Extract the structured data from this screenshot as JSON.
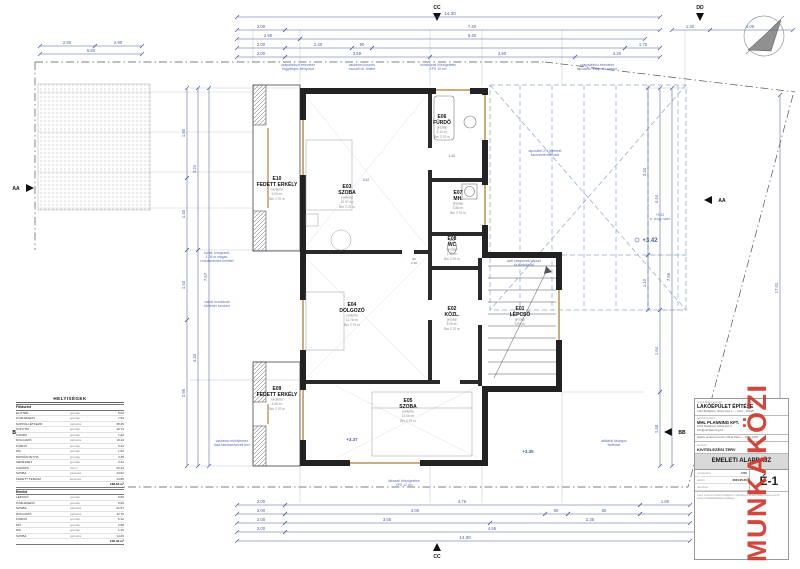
{
  "stamp": "MUNKAKÖZI",
  "colors": {
    "dim": "#4a5f9e",
    "note": "#5b6fb5",
    "roof": "#8ca6cf",
    "wall": "#222222",
    "tan": "#c8a06a",
    "red": "#d0382c"
  },
  "table": {
    "title": "HELYISÉGEK",
    "rows": [
      {
        "cls": "trow head",
        "name": "Földszint",
        "fin": "",
        "area": ""
      },
      {
        "cls": "trow",
        "name": "ELŐTÉR",
        "fin": "greslap",
        "area": "5.62"
      },
      {
        "cls": "trow",
        "name": "KÖZLEKEDŐ",
        "fin": "greslap",
        "area": "7.54"
      },
      {
        "cls": "trow",
        "name": "NAPPALI-ÉTKEZŐ",
        "fin": "parketta",
        "area": "38.45"
      },
      {
        "cls": "trow",
        "name": "KONYHA",
        "fin": "greslap",
        "area": "15.72"
      },
      {
        "cls": "trow",
        "name": "KAMRA",
        "fin": "greslap",
        "area": "1.92"
      },
      {
        "cls": "trow",
        "name": "DOLGOZÓ",
        "fin": "parketta",
        "area": "10.14"
      },
      {
        "cls": "trow",
        "name": "FÜRDŐ",
        "fin": "greslap",
        "area": "5.24"
      },
      {
        "cls": "trow",
        "name": "WC",
        "fin": "greslap",
        "area": "1.52"
      },
      {
        "cls": "trow",
        "name": "MOSÓKONYHA",
        "fin": "greslap",
        "area": "4.35"
      },
      {
        "cls": "trow",
        "name": "GÉPÉSZET",
        "fin": "greslap",
        "area": "3.41"
      },
      {
        "cls": "trow",
        "name": "GARÁZS",
        "fin": "beton",
        "area": "20.44"
      },
      {
        "cls": "trow",
        "name": "SZOBA",
        "fin": "parketta",
        "area": "13.62"
      },
      {
        "cls": "trow",
        "name": "FEDETT TERASZ",
        "fin": "kerámia",
        "area": "14.85"
      },
      {
        "cls": "trow sum",
        "name": "",
        "fin": "",
        "area": "188.62 m²"
      },
      {
        "cls": "trow head",
        "name": "Emelet",
        "fin": "",
        "area": ""
      },
      {
        "cls": "trow",
        "name": "LÉPCSŐ",
        "fin": "greslap",
        "area": "6.80"
      },
      {
        "cls": "trow",
        "name": "KÖZLEKEDŐ",
        "fin": "greslap",
        "area": "5.06"
      },
      {
        "cls": "trow",
        "name": "SZOBA",
        "fin": "parketta",
        "area": "21.97"
      },
      {
        "cls": "trow",
        "name": "DOLGOZÓ",
        "fin": "parketta",
        "area": "12.76"
      },
      {
        "cls": "trow",
        "name": "FÜRDŐ",
        "fin": "greslap",
        "area": "6.12"
      },
      {
        "cls": "trow",
        "name": "MH.",
        "fin": "greslap",
        "area": "2.88"
      },
      {
        "cls": "trow",
        "name": "WC",
        "fin": "greslap",
        "area": "1.15"
      },
      {
        "cls": "trow",
        "name": "SZOBA",
        "fin": "parketta",
        "area": "14.06"
      },
      {
        "cls": "trow sum",
        "name": "",
        "fin": "",
        "area": "106.40 m²"
      }
    ]
  },
  "titleblock": {
    "client_label": "megrendelő / építtető",
    "project": "LAKÓÉPÜLET ÉPÍTÉSE",
    "project_addr": "1112 Budapest, Minta utca 1. — Hrsz.: 1234/5",
    "designer_label": "generál tervező",
    "firm": "MHL PLANNING KFT.",
    "firm_addr1": "1023 Budapest, Minta köz 2.",
    "firm_addr2": "info@mhlplanning.hu",
    "resp": "felelős építész tervező: Minta Péter — É 01-2345",
    "phase_label": "tervfázis",
    "phase": "KIVITELEZÉSI TERV",
    "title": "EMELETI ALAPRAJZ",
    "scale_label": "méretarány",
    "scale": "1:50",
    "date_label": "dátum",
    "date": "2021.05.25",
    "sheet_label": "rajzszám",
    "sheet": "É-1",
    "note": "A terv a tervező szellemi tulajdona, másolása és felhasználása csak a tervező írásos hozzájárulásával lehetséges."
  },
  "drawing": {
    "dim_lines": [
      [
        237,
        17,
        660,
        17
      ],
      [
        237,
        30,
        285,
        30
      ],
      [
        285,
        30,
        660,
        30
      ],
      [
        237,
        39,
        300,
        39
      ],
      [
        300,
        39,
        645,
        39
      ],
      [
        237,
        48,
        285,
        48
      ],
      [
        285,
        48,
        352,
        48
      ],
      [
        352,
        48,
        372,
        48
      ],
      [
        372,
        48,
        625,
        48
      ],
      [
        625,
        48,
        660,
        48
      ],
      [
        237,
        57,
        285,
        57
      ],
      [
        285,
        57,
        430,
        57
      ],
      [
        430,
        57,
        575,
        57
      ],
      [
        575,
        57,
        660,
        57
      ],
      [
        40,
        46,
        95,
        46
      ],
      [
        95,
        46,
        142,
        46
      ],
      [
        40,
        54,
        142,
        54
      ],
      [
        672,
        30,
        710,
        30
      ],
      [
        710,
        30,
        793,
        30
      ],
      [
        237,
        505,
        285,
        505
      ],
      [
        285,
        505,
        640,
        505
      ],
      [
        640,
        505,
        690,
        505
      ],
      [
        237,
        514,
        285,
        514
      ],
      [
        285,
        514,
        545,
        514
      ],
      [
        545,
        514,
        568,
        514
      ],
      [
        568,
        514,
        640,
        514
      ],
      [
        640,
        514,
        690,
        514
      ],
      [
        237,
        523,
        285,
        523
      ],
      [
        285,
        523,
        490,
        523
      ],
      [
        490,
        523,
        690,
        523
      ],
      [
        237,
        532,
        285,
        532
      ],
      [
        285,
        532,
        700,
        532
      ],
      [
        237,
        541,
        690,
        541
      ],
      [
        187,
        88,
        187,
        178
      ],
      [
        187,
        178,
        187,
        250
      ],
      [
        187,
        250,
        187,
        320
      ],
      [
        187,
        320,
        187,
        466
      ],
      [
        198,
        88,
        198,
        250
      ],
      [
        198,
        250,
        198,
        466
      ],
      [
        209,
        88,
        209,
        466
      ],
      [
        648,
        88,
        648,
        255
      ],
      [
        648,
        255,
        648,
        310
      ],
      [
        660,
        88,
        660,
        310
      ],
      [
        660,
        310,
        660,
        392
      ],
      [
        660,
        392,
        660,
        466
      ],
      [
        672,
        88,
        672,
        466
      ],
      [
        780,
        95,
        780,
        480
      ]
    ],
    "texts": [
      {
        "x": 450,
        "y": 15,
        "t": "14.30",
        "s": 4.6
      },
      {
        "x": 261,
        "y": 28,
        "t": "2.00"
      },
      {
        "x": 472,
        "y": 28,
        "t": "7.40"
      },
      {
        "x": 268,
        "y": 37,
        "t": "2.90"
      },
      {
        "x": 472,
        "y": 37,
        "t": "6.40"
      },
      {
        "x": 261,
        "y": 46,
        "t": "2.00"
      },
      {
        "x": 318,
        "y": 46,
        "t": "2.40"
      },
      {
        "x": 362,
        "y": 46,
        "t": "90"
      },
      {
        "x": 643,
        "y": 46,
        "t": "1.75"
      },
      {
        "x": 261,
        "y": 55,
        "t": "2.00"
      },
      {
        "x": 357,
        "y": 55,
        "t": "3.59"
      },
      {
        "x": 502,
        "y": 55,
        "t": "2.90"
      },
      {
        "x": 617,
        "y": 55,
        "t": "4.20"
      },
      {
        "x": 67,
        "y": 44,
        "t": "2.93"
      },
      {
        "x": 118,
        "y": 44,
        "t": "2.90"
      },
      {
        "x": 91,
        "y": 52,
        "t": "5.83"
      },
      {
        "x": 690,
        "y": 28,
        "t": "1.30"
      },
      {
        "x": 750,
        "y": 28,
        "t": "4.05"
      },
      {
        "x": 261,
        "y": 503,
        "t": "2.00"
      },
      {
        "x": 462,
        "y": 503,
        "t": "4.75"
      },
      {
        "x": 665,
        "y": 503,
        "t": "1.80"
      },
      {
        "x": 261,
        "y": 512,
        "t": "2.00"
      },
      {
        "x": 415,
        "y": 512,
        "t": "4.00"
      },
      {
        "x": 556,
        "y": 512,
        "t": "90"
      },
      {
        "x": 604,
        "y": 512,
        "t": "80"
      },
      {
        "x": 261,
        "y": 521,
        "t": "2.00"
      },
      {
        "x": 387,
        "y": 521,
        "t": "3.55"
      },
      {
        "x": 590,
        "y": 521,
        "t": "2.35"
      },
      {
        "x": 261,
        "y": 530,
        "t": "2.00"
      },
      {
        "x": 492,
        "y": 530,
        "t": "4.55"
      },
      {
        "x": 465,
        "y": 539,
        "t": "14.30",
        "s": 4.6
      },
      {
        "x": 185,
        "y": 133,
        "t": "1.80",
        "r": -90
      },
      {
        "x": 185,
        "y": 214,
        "t": "1.40",
        "r": -90
      },
      {
        "x": 185,
        "y": 285,
        "t": "1.40",
        "r": -90
      },
      {
        "x": 185,
        "y": 393,
        "t": "2.95",
        "r": -90
      },
      {
        "x": 196,
        "y": 169,
        "t": "3.24",
        "r": -90
      },
      {
        "x": 196,
        "y": 358,
        "t": "4.33",
        "r": -90
      },
      {
        "x": 207,
        "y": 277,
        "t": "7.57",
        "r": -90
      },
      {
        "x": 646,
        "y": 172,
        "t": "3.34",
        "r": -90
      },
      {
        "x": 646,
        "y": 283,
        "t": "1.10",
        "r": -90
      },
      {
        "x": 658,
        "y": 199,
        "t": "4.44",
        "r": -90
      },
      {
        "x": 658,
        "y": 351,
        "t": "1.64",
        "r": -90
      },
      {
        "x": 658,
        "y": 429,
        "t": "1.48",
        "r": -90
      },
      {
        "x": 670,
        "y": 277,
        "t": "7.56",
        "r": -90
      },
      {
        "x": 778,
        "y": 288,
        "t": "17.01",
        "r": -90
      },
      {
        "x": 366,
        "y": 181,
        "t": "5.42",
        "s": 3.4
      },
      {
        "x": 452,
        "y": 157,
        "t": "1.40",
        "s": 3.2
      },
      {
        "x": 414,
        "y": 260,
        "t": "90",
        "s": 3
      },
      {
        "x": 414,
        "y": 264,
        "t": "2.10",
        "s": 3
      },
      {
        "x": 650,
        "y": 242,
        "t": "+3.42",
        "s": 6,
        "w": 1,
        "n": "level-marker"
      },
      {
        "x": 352,
        "y": 441,
        "t": "+3.37",
        "s": 4.5,
        "w": 1,
        "n": "level-marker"
      },
      {
        "x": 528,
        "y": 453,
        "t": "+3.35",
        "s": 4.5,
        "w": 1,
        "n": "level-marker"
      },
      {
        "x": 16,
        "y": 190,
        "t": "AA",
        "s": 5,
        "w": 1,
        "c": "#111111",
        "n": "section-label"
      },
      {
        "x": 722,
        "y": 202,
        "t": "AA",
        "s": 5,
        "w": 1,
        "c": "#111111",
        "n": "section-label"
      },
      {
        "x": 16,
        "y": 434,
        "t": "BB",
        "s": 5,
        "w": 1,
        "c": "#111111",
        "n": "section-label"
      },
      {
        "x": 682,
        "y": 434,
        "t": "BB",
        "s": 5,
        "w": 1,
        "c": "#111111",
        "n": "section-label"
      },
      {
        "x": 437,
        "y": 9,
        "t": "CC",
        "s": 5,
        "w": 1,
        "c": "#111111",
        "n": "section-label"
      },
      {
        "x": 437,
        "y": 558,
        "t": "CC",
        "s": 5,
        "w": 1,
        "c": "#111111",
        "n": "section-label"
      },
      {
        "x": 700,
        "y": 9,
        "t": "DD",
        "s": 5,
        "w": 1,
        "c": "#111111",
        "n": "section-label"
      },
      {
        "x": 700,
        "y": 558,
        "t": "DD",
        "s": 5,
        "w": 1,
        "c": "#111111",
        "n": "section-label"
      }
    ],
    "notes": [
      {
        "x": 298,
        "y": 66,
        "lines": [
          "csapadékvíz elvezetés",
          "függőleges lefolyóval"
        ]
      },
      {
        "x": 362,
        "y": 66,
        "lines": [
          "vasbeton koszorú",
          "monolit vb. födém"
        ]
      },
      {
        "x": 438,
        "y": 66,
        "lines": [
          "homlokzati hőszigetelés",
          "EPS 15 cm"
        ]
      },
      {
        "x": 597,
        "y": 66,
        "lines": [
          "csapadékvíz elvezetés",
          "lapostető rétegrend szerint"
        ]
      },
      {
        "x": 217,
        "y": 254,
        "lines": [
          "korlát: üvegezett,",
          "1.05 m magas,",
          "rozsdamentes kerettel"
        ]
      },
      {
        "x": 217,
        "y": 303,
        "lines": [
          "vakolt homlokzat",
          "törtfehér színben"
        ]
      },
      {
        "x": 524,
        "y": 262,
        "lines": [
          "acél szerkezetű lépcső",
          "fa burkolattal"
        ]
      },
      {
        "x": 232,
        "y": 442,
        "lines": [
          "vasbeton erkélylemez",
          "lásd tartószerkezeti terv"
        ]
      },
      {
        "x": 404,
        "y": 482,
        "lines": [
          "lábazati hőszigetelés",
          "XPS 12 cm"
        ]
      },
      {
        "x": 614,
        "y": 442,
        "lines": [
          "attikafal bádogos",
          "fedéssel"
        ]
      },
      {
        "x": 660,
        "y": 216,
        "lines": [
          "+5.32",
          "b. vízgy. szint"
        ]
      },
      {
        "x": 545,
        "y": 152,
        "lines": [
          "lapostető 2% lejtéssel",
          "kavicsleterheléssel"
        ]
      }
    ],
    "rooms": [
      {
        "x": 277,
        "y": 180,
        "id": "E10",
        "name": "FEDETT ERKÉLY",
        "sub": [
          "kerámia",
          "6.04 m²",
          "Bm 2.70 m"
        ]
      },
      {
        "x": 347,
        "y": 188,
        "id": "E03",
        "name": "SZOBA",
        "sub": [
          "parketta",
          "21.97 m²",
          "Bm 2.70 m"
        ]
      },
      {
        "x": 442,
        "y": 118,
        "id": "E06",
        "name": "FÜRDŐ",
        "sub": [
          "greslap",
          "6.12 m²",
          "Bm 2.70 m"
        ]
      },
      {
        "x": 458,
        "y": 194,
        "id": "E07",
        "name": "MH.",
        "sub": [
          "greslap",
          "2.88 m²",
          "Bm 2.70 m"
        ]
      },
      {
        "x": 452,
        "y": 240,
        "id": "E08",
        "name": "WC",
        "sub": [
          "greslap",
          "1.15 m²",
          "Bm 2.70 m"
        ]
      },
      {
        "x": 352,
        "y": 306,
        "id": "E04",
        "name": "DOLGOZÓ",
        "sub": [
          "parketta",
          "12.76 m²",
          "Bm 2.70 m"
        ]
      },
      {
        "x": 452,
        "y": 310,
        "id": "E02",
        "name": "KÖZL.",
        "sub": [
          "greslap",
          "5.06 m²",
          "Bm 2.70 m"
        ]
      },
      {
        "x": 520,
        "y": 310,
        "id": "E01",
        "name": "LÉPCSŐ",
        "sub": [
          "greslap",
          "6.80 m²"
        ]
      },
      {
        "x": 277,
        "y": 390,
        "id": "E09",
        "name": "FEDETT ERKÉLY",
        "sub": [
          "kerámia",
          "4.58 m²",
          "Bm 2.70 m"
        ]
      },
      {
        "x": 408,
        "y": 402,
        "id": "E05",
        "name": "SZOBA",
        "sub": [
          "parketta",
          "14.06 m²",
          "Bm 2.70 m"
        ]
      }
    ]
  }
}
